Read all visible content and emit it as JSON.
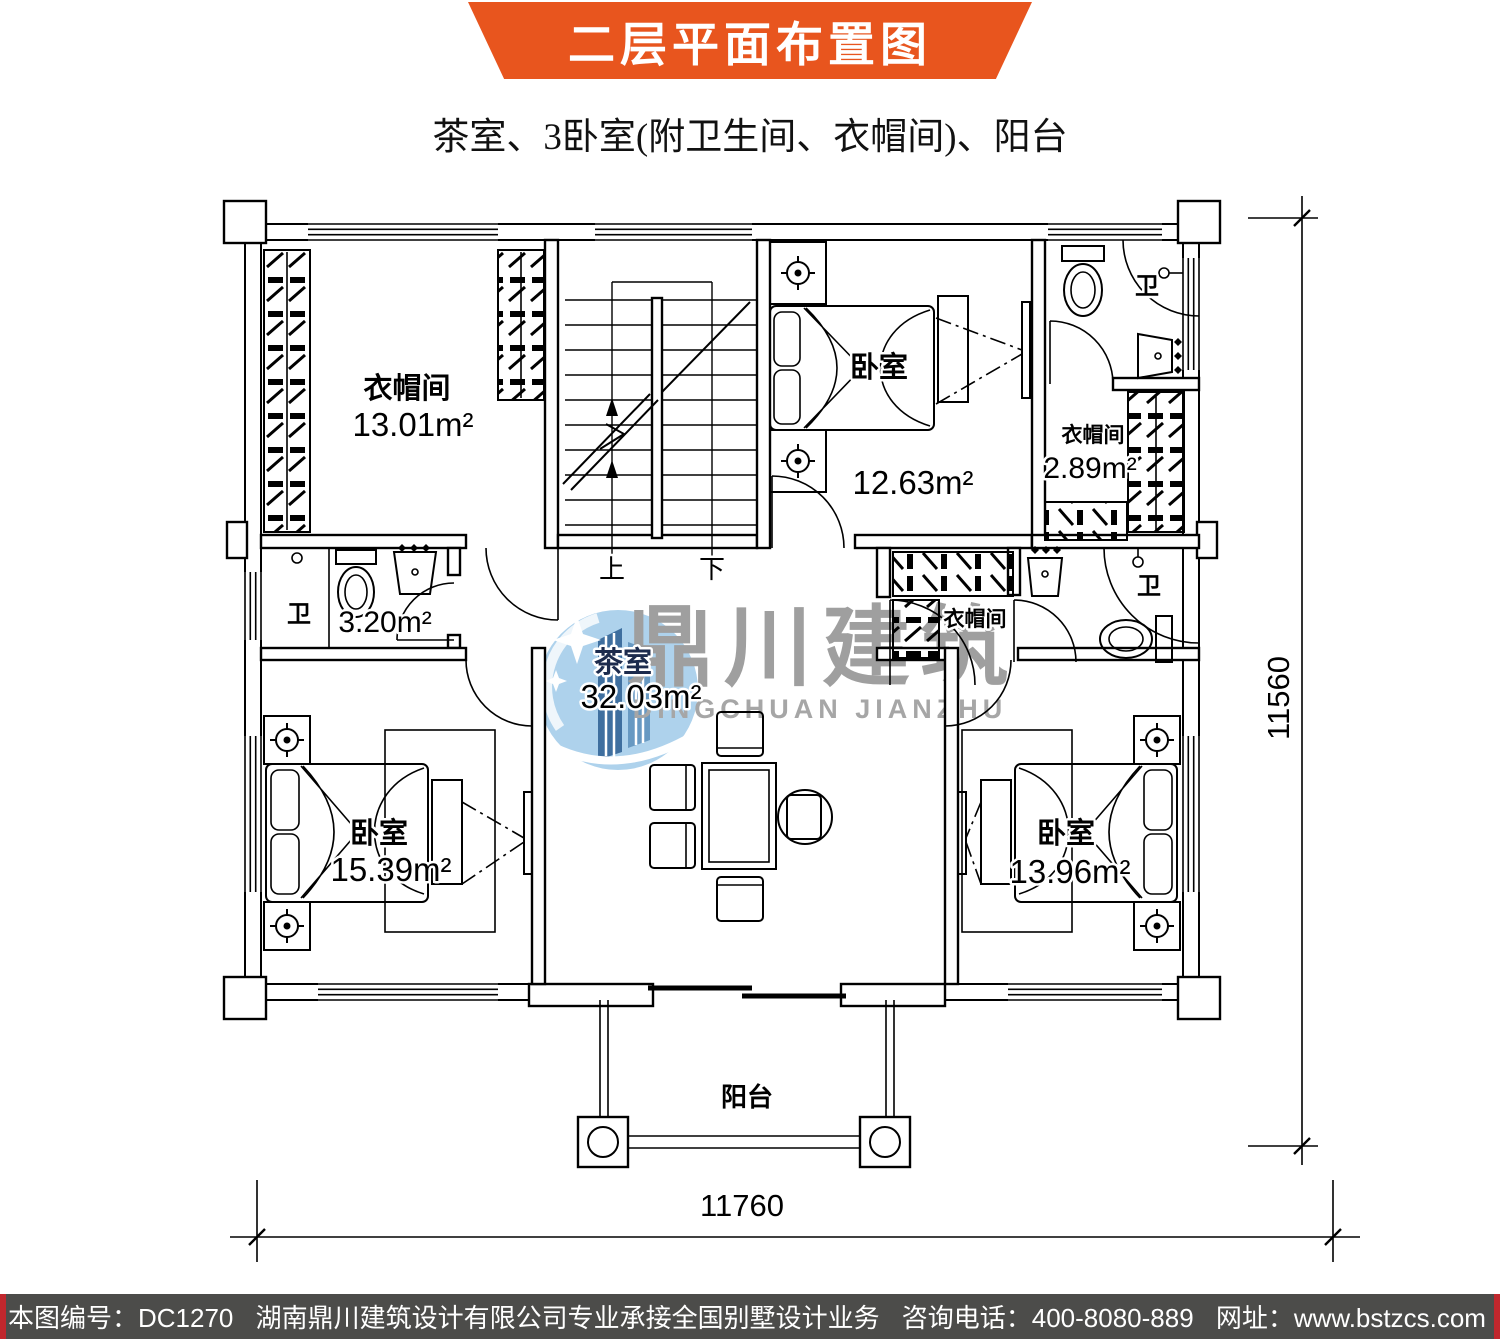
{
  "header": {
    "title": "二层平面布置图",
    "subtitle": "茶室、3卧室(附卫生间、衣帽间)、阳台"
  },
  "rooms": {
    "cloakroom_top_left": {
      "label": "衣帽间",
      "area": "13.01m²"
    },
    "bedroom_top_right": {
      "label": "卧室",
      "area": "12.63m²"
    },
    "bathroom_top_right": {
      "label": "卫"
    },
    "cloakroom_right": {
      "label": "衣帽间",
      "area": "2.89m²"
    },
    "bathroom_left": {
      "label": "卫",
      "area": "3.20m²"
    },
    "tea_room": {
      "label": "茶室",
      "area": "32.03m²"
    },
    "cloakroom_middle": {
      "label": "衣帽间"
    },
    "bathroom_right": {
      "label": "卫"
    },
    "bedroom_bottom_left": {
      "label": "卧室",
      "area": "15.39m²"
    },
    "bedroom_bottom_right": {
      "label": "卧室",
      "area": "13.96m²"
    },
    "balcony": {
      "label": "阳台"
    }
  },
  "stairs": {
    "up": "上",
    "down": "下"
  },
  "dimensions": {
    "width": "11760",
    "height": "11560"
  },
  "watermark": {
    "cn": "鼎川建筑",
    "en": "DINGCHUAN JIANZHU"
  },
  "footer": {
    "drawing_no": "本图编号：DC1270",
    "company": "湖南鼎川建筑设计有限公司专业承接全国别墅设计业务",
    "phone": "咨询电话：400-8080-889",
    "website": "网址：www.bstzcs.com"
  },
  "colors": {
    "banner": "#E8551E",
    "footer_bg": "#4C4C4A",
    "footer_accent": "#C0272D",
    "watermark_blue": "#AED2EC",
    "watermark_building": "#3F6F9F",
    "watermark_text": "#9F9F9F",
    "tea_label": "#1C2B4D"
  }
}
